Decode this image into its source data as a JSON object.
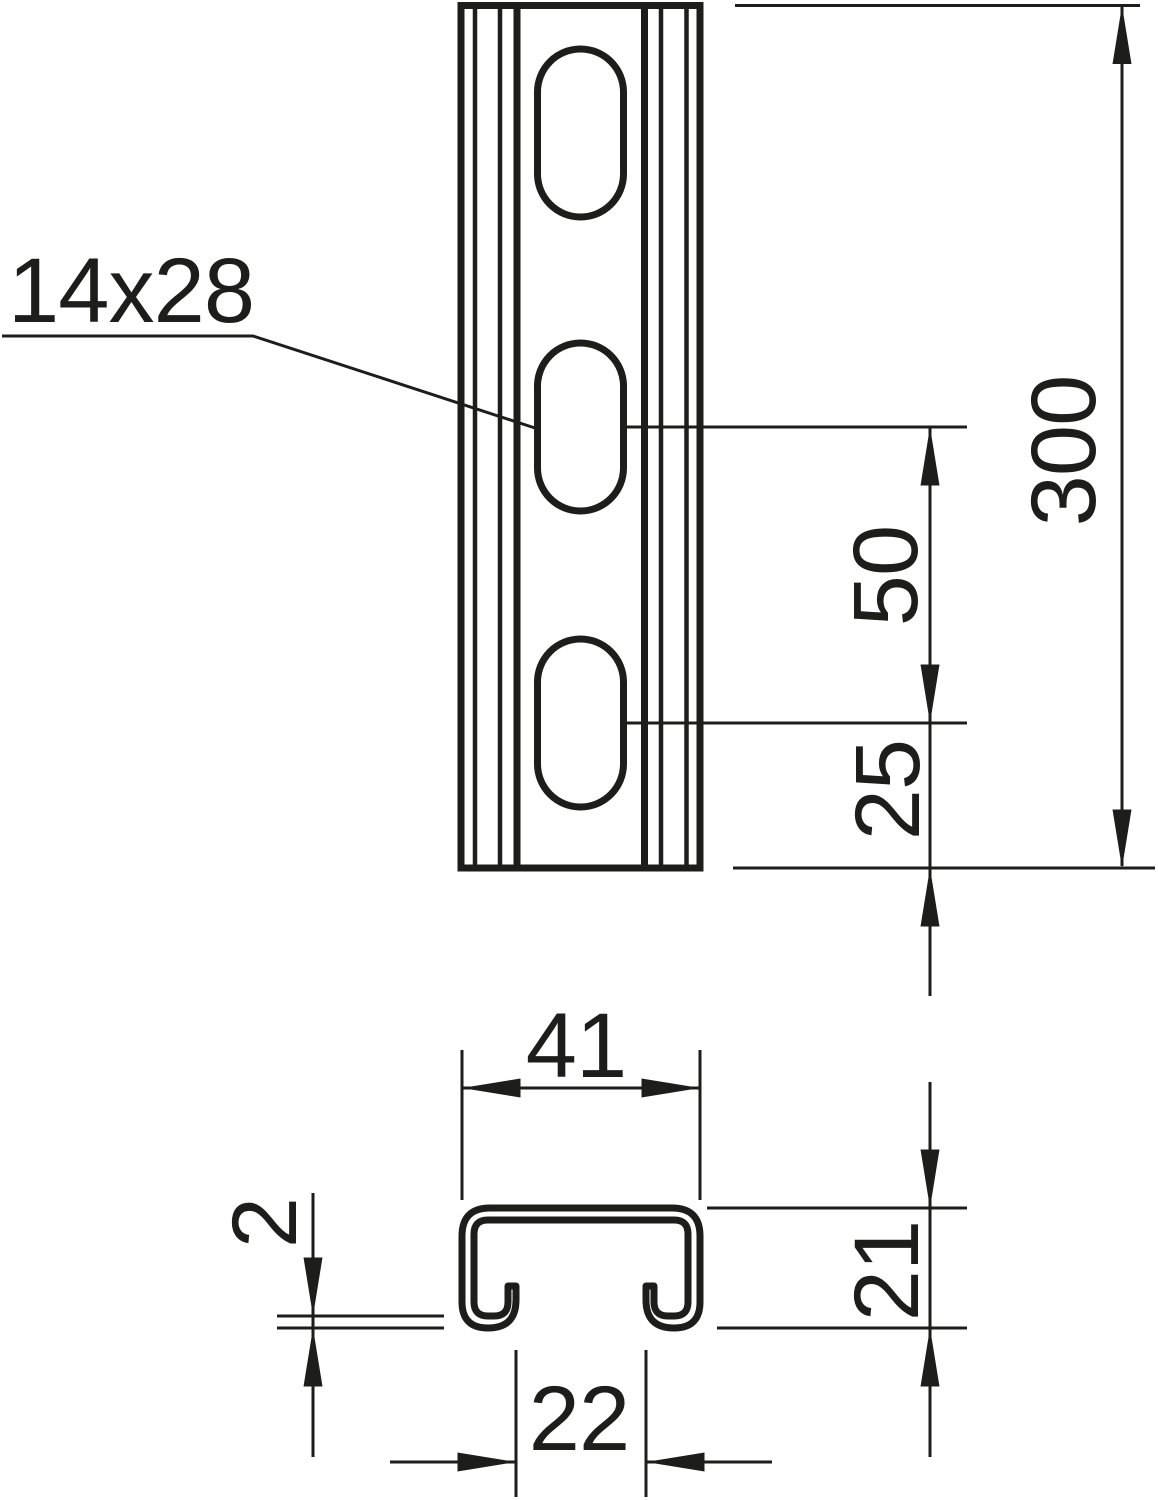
{
  "drawing": {
    "background_color": "#ffffff",
    "line_color": "#1d1d1b",
    "slot_callout": "14x28",
    "front_view": {
      "length": "300",
      "slot_pitch": "50",
      "slot_end_distance": "25"
    },
    "profile": {
      "width": "41",
      "height": "21",
      "opening": "22",
      "thickness": "2"
    }
  }
}
